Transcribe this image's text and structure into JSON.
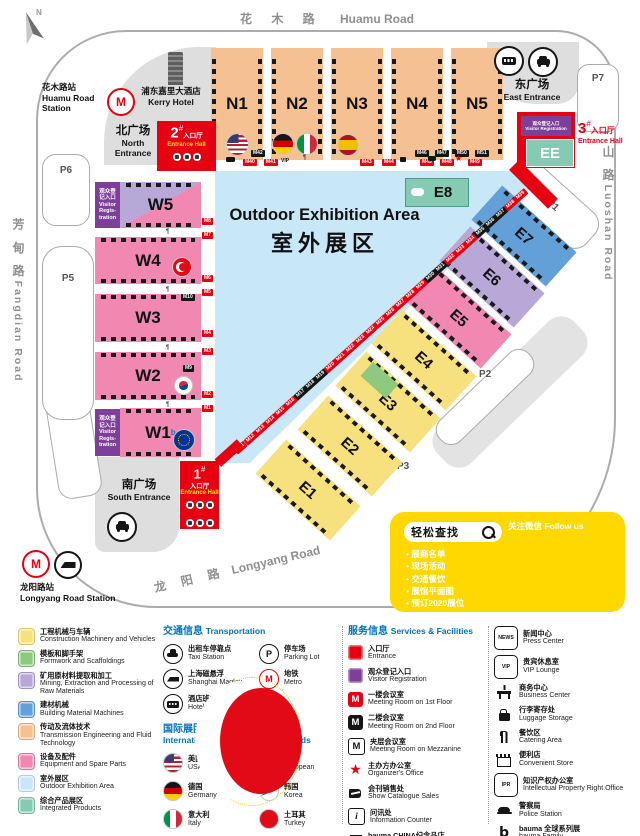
{
  "colors": {
    "red": "#E60012",
    "purple": "#7D3F98",
    "heading_blue": "#0072BC",
    "promo_yellow": "#FFD800",
    "peach": "#F5C193",
    "pink": "#F088B2",
    "lavender": "#B7A8D8",
    "blue": "#63A0D8",
    "yellow": "#F7E17E",
    "green": "#8FC97F",
    "sky_blue": "#C9E8F7",
    "teal": "#85CBB4"
  },
  "map": {
    "compass_n": "N",
    "roads": {
      "top_cn": "花 木 路",
      "top_en": "Huamu Road",
      "right_cn": "罗 山 路",
      "right_en": "Luoshan Road",
      "left_cn": "芳 甸 路",
      "left_en": "Fangdian Road",
      "bottom_cn": "龙 阳 路",
      "bottom_en": "Longyang Road"
    },
    "stations": {
      "huamu_cn": "花木路站",
      "huamu_en": "Huamu Road Station",
      "longyang_cn": "龙阳路站",
      "longyang_en": "Longyang Road Station"
    },
    "kerry": {
      "cn": "浦东嘉里大酒店",
      "en": "Kerry Hotel"
    },
    "plazas": {
      "north_cn": "北广场",
      "north_en": "North Entrance",
      "east_cn": "东广场",
      "east_en": "East Entrance",
      "south_cn": "南广场",
      "south_en": "South Entrance"
    },
    "ent": {
      "n1": "1",
      "n2": "2",
      "n3": "3",
      "hash": "#",
      "cn": "入口厅",
      "en": "Entrance Hall"
    },
    "vr": {
      "l1": "观众登",
      "l2": "记入口",
      "l3": "Visitor",
      "l4": "Regis-",
      "l5": "tration",
      "cn": "观众登记入口",
      "en": "Visitor Registration"
    },
    "outdoor": {
      "en": "Outdoor Exhibition Area",
      "cn": "室外展区"
    },
    "halls": {
      "n": [
        "N1",
        "N2",
        "N3",
        "N4",
        "N5"
      ],
      "w": [
        "W5",
        "W4",
        "W3",
        "W2",
        "W1"
      ],
      "e": [
        "E7",
        "E6",
        "E5",
        "E4",
        "E3",
        "E2",
        "E1"
      ],
      "e8": "E8",
      "ee": "EE",
      "w1_sup": "b"
    },
    "parking": [
      "P1",
      "P2",
      "P3",
      "P4",
      "P5",
      "P6",
      "P7"
    ],
    "vip": "VIP",
    "m9": "M9",
    "m10": "M10",
    "left_labels": [
      {
        "t": "M8",
        "y": 218
      },
      {
        "t": "M7",
        "y": 232
      },
      {
        "t": "M6",
        "y": 275
      },
      {
        "t": "M5",
        "y": 289
      },
      {
        "t": "M4",
        "y": 330
      },
      {
        "t": "M3",
        "y": 348
      },
      {
        "t": "M2",
        "y": 391
      },
      {
        "t": "M1",
        "y": 405
      }
    ],
    "north_black": [
      {
        "t": "M42",
        "x": 251
      },
      {
        "t": "M46",
        "x": 415
      },
      {
        "t": "M47",
        "x": 435
      },
      {
        "t": "M50",
        "x": 455
      },
      {
        "t": "M51",
        "x": 475
      }
    ],
    "north_red": [
      {
        "t": "M40",
        "x": 243
      },
      {
        "t": "M41",
        "x": 264
      },
      {
        "t": "M43",
        "x": 360
      },
      {
        "t": "M44",
        "x": 382
      },
      {
        "t": "M45",
        "x": 420
      },
      {
        "t": "M48",
        "x": 440
      },
      {
        "t": "M49",
        "x": 468
      }
    ],
    "diag_labels": [
      {
        "t": "M11",
        "x": 234,
        "y": 444
      },
      {
        "t": "M12",
        "x": 244,
        "y": 435
      },
      {
        "t": "M13",
        "x": 254,
        "y": 426
      },
      {
        "t": "M14",
        "x": 264,
        "y": 417
      },
      {
        "t": "M15",
        "x": 274,
        "y": 408
      },
      {
        "t": "M16",
        "x": 284,
        "y": 399
      },
      {
        "t": "M17",
        "x": 294,
        "y": 390,
        "c": "k"
      },
      {
        "t": "M18",
        "x": 304,
        "y": 381,
        "c": "k"
      },
      {
        "t": "M19",
        "x": 314,
        "y": 372,
        "c": "k"
      },
      {
        "t": "M20",
        "x": 324,
        "y": 363
      },
      {
        "t": "M21",
        "x": 334,
        "y": 354
      },
      {
        "t": "M22",
        "x": 344,
        "y": 345
      },
      {
        "t": "M23",
        "x": 354,
        "y": 336
      },
      {
        "t": "M24",
        "x": 364,
        "y": 327
      },
      {
        "t": "M25",
        "x": 374,
        "y": 318
      },
      {
        "t": "M26",
        "x": 384,
        "y": 309
      },
      {
        "t": "M27",
        "x": 394,
        "y": 300
      },
      {
        "t": "M28",
        "x": 404,
        "y": 291
      },
      {
        "t": "M29",
        "x": 414,
        "y": 282
      },
      {
        "t": "M30",
        "x": 424,
        "y": 273,
        "c": "k"
      },
      {
        "t": "M31",
        "x": 434,
        "y": 264,
        "c": "k"
      },
      {
        "t": "M32",
        "x": 444,
        "y": 255
      },
      {
        "t": "M33",
        "x": 454,
        "y": 246
      },
      {
        "t": "M34",
        "x": 464,
        "y": 237
      },
      {
        "t": "M35",
        "x": 474,
        "y": 228,
        "c": "k"
      },
      {
        "t": "M36",
        "x": 484,
        "y": 219,
        "c": "k"
      },
      {
        "t": "M37",
        "x": 494,
        "y": 210,
        "c": "k"
      },
      {
        "t": "M38",
        "x": 504,
        "y": 201
      },
      {
        "t": "M39",
        "x": 514,
        "y": 192
      }
    ],
    "forks": [
      {
        "x": 166,
        "y": 229
      },
      {
        "x": 166,
        "y": 287
      },
      {
        "x": 166,
        "y": 345
      },
      {
        "x": 166,
        "y": 402
      },
      {
        "x": 303,
        "y": 155
      },
      {
        "x": 128,
        "y": 183
      }
    ]
  },
  "qr_box": {
    "search": "轻松查找",
    "follow": "关注微信 Follow us",
    "b_logo": "b",
    "bullets": [
      "展商名单",
      "现场活动",
      "交通餐饮",
      "展馆平面图",
      "预订2020展位"
    ]
  },
  "legend": {
    "categories": [
      {
        "cn": "工程机械与车辆",
        "en": "Construction Machinery and Vehicles",
        "cls": "c-yellow",
        "color": "#F7E17E"
      },
      {
        "cn": "模板和脚手架",
        "en": "Formwork and Scaffoldings",
        "cls": "c-green",
        "color": "#8FC97F"
      },
      {
        "cn": "矿用原材料提取和加工",
        "en": "Mining, Extraction and Processing of Raw Materials",
        "cls": "c-lav",
        "color": "#B7A8D8"
      },
      {
        "cn": "建材机械",
        "en": "Building Material Machines",
        "cls": "c-blue",
        "color": "#63A0D8"
      },
      {
        "cn": "传动及流体技术",
        "en": "Transmission Engineering and Fluid Technology",
        "cls": "c-peach",
        "color": "#F5C193"
      },
      {
        "cn": "设备及配件",
        "en": "Equipment and Spare Parts",
        "cls": "c-pink",
        "color": "#F088B2"
      },
      {
        "cn": "室外展区",
        "en": "Outdoor Exhibition Area",
        "cls": "c-sky",
        "color": "#C9E8F7"
      },
      {
        "cn": "综合产品展区",
        "en": "Integrated Products",
        "cls": "c-teal",
        "color": "#85CBB4"
      }
    ],
    "transport": {
      "heading_cn": "交通信息",
      "heading_en": "Transportation",
      "items": [
        {
          "cn": "出租车停靠点",
          "en": "Taxi Station",
          "icon": "ic-taxi",
          "glyph": ""
        },
        {
          "cn": "停车场",
          "en": "Parking Lot",
          "icon": "ic-parking",
          "glyph": "P"
        },
        {
          "cn": "上海磁悬浮",
          "en": "Shanghai Maglev",
          "icon": "ic-maglev",
          "glyph": ""
        },
        {
          "cn": "地铁",
          "en": "Metro",
          "icon": "ic-metro",
          "glyph": "M"
        },
        {
          "cn": "酒店班车停靠点",
          "en": "Hotel Shuttle Bus",
          "icon": "ic-shuttle",
          "glyph": ""
        }
      ]
    },
    "intl": {
      "heading_cn": "国际展团",
      "heading_en": "International Joint Exhibition Stands",
      "flags": [
        {
          "cn": "美国",
          "en": "USA",
          "flag": "fl-usa"
        },
        {
          "cn": "欧盟",
          "en": "European",
          "flag": "fl-eu"
        },
        {
          "cn": "德国",
          "en": "Germany",
          "flag": "fl-ger"
        },
        {
          "cn": "韩国",
          "en": "Korea",
          "flag": "fl-kor"
        },
        {
          "cn": "意大利",
          "en": "Italy",
          "flag": "fl-ita"
        },
        {
          "cn": "土耳其",
          "en": "Turkey",
          "flag": "fl-tur"
        },
        {
          "cn": "西班牙",
          "en": "Spain",
          "flag": "fl-spa"
        }
      ]
    },
    "services": {
      "heading_cn": "服务信息",
      "heading_en": "Services & Facilities",
      "items": [
        {
          "cn": "入口厅",
          "en": "Entrance",
          "icon": "ic-sq-red",
          "glyph": ""
        },
        {
          "cn": "观众登记入口",
          "en": "Visitor Registration",
          "icon": "ic-sq-purple",
          "glyph": ""
        },
        {
          "cn": "一楼会议室",
          "en": "Meeting Room on 1st Floor",
          "icon": "ic-m-red",
          "glyph": "M"
        },
        {
          "cn": "二楼会议室",
          "en": "Meeting Room on 2nd Floor",
          "icon": "ic-m-black",
          "glyph": "M"
        },
        {
          "cn": "夹层会议室",
          "en": "Meeting Room on Mezzanine",
          "icon": "ic-m-mezz",
          "glyph": "M"
        },
        {
          "cn": "主办方办公室",
          "en": "Organizer's Office",
          "icon": "ic-star",
          "glyph": "★"
        },
        {
          "cn": "会刊销售处",
          "en": "Show Catalogue Sales",
          "icon": "ic-book",
          "glyph": ""
        },
        {
          "cn": "问讯处",
          "en": "Information Counter",
          "icon": "ic-info",
          "glyph": "i"
        },
        {
          "cn": "bauma CHINA纪念品店",
          "en": "bauma CHINA Shop",
          "icon": "ic-gift",
          "glyph": ""
        }
      ]
    },
    "facilities": [
      {
        "cn": "新闻中心",
        "en": "Press Center",
        "icon": "ic-news",
        "glyph": "NEWS"
      },
      {
        "cn": "贵宾休息室",
        "en": "VIP Lounge",
        "icon": "ic-vip",
        "glyph": "VIP"
      },
      {
        "cn": "商务中心",
        "en": "Business Center",
        "icon": "ic-biz",
        "glyph": ""
      },
      {
        "cn": "行李寄存处",
        "en": "Luggage Storage",
        "icon": "ic-bag",
        "glyph": ""
      },
      {
        "cn": "餐饮区",
        "en": "Catering Area",
        "icon": "ic-food",
        "glyph": ""
      },
      {
        "cn": "便利店",
        "en": "Convenient Store",
        "icon": "ic-store",
        "glyph": ""
      },
      {
        "cn": "知识产权办公室",
        "en": "Intellectual Property Right Office",
        "icon": "ic-ipr",
        "glyph": "IPR"
      },
      {
        "cn": "警察局",
        "en": "Police Station",
        "icon": "ic-police",
        "glyph": ""
      },
      {
        "cn": "bauma 全球系列展",
        "en": "bauma Family",
        "icon": "ic-bfam",
        "glyph": "b"
      },
      {
        "cn": "充电区",
        "en": "Charging Area",
        "icon": "ic-charge",
        "glyph": ""
      }
    ]
  }
}
